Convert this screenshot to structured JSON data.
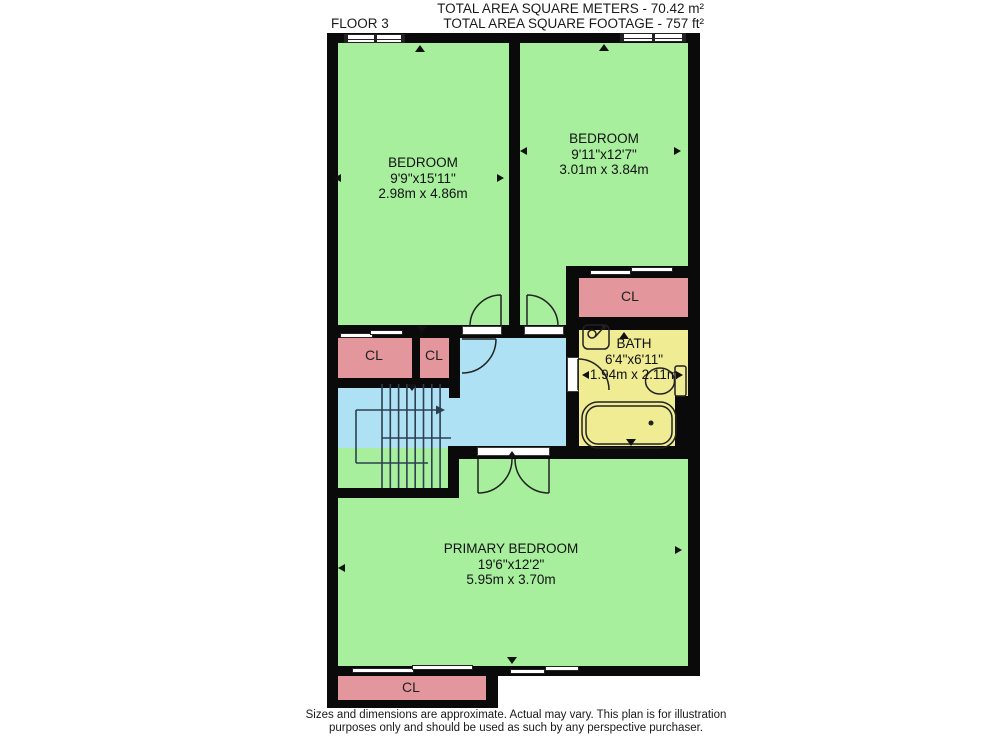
{
  "header": {
    "floor_label": "FLOOR 3",
    "total_area_metric": "TOTAL AREA SQUARE METERS - 70.42 m²",
    "total_area_imperial": "TOTAL AREA SQUARE FOOTAGE - 757 ft²"
  },
  "rooms": {
    "bedroom_left": {
      "name": "BEDROOM",
      "imperial": "9'9\"x15'11\"",
      "metric": "2.98m x 4.86m"
    },
    "bedroom_right": {
      "name": "BEDROOM",
      "imperial": "9'11\"x12'7\"",
      "metric": "3.01m x 3.84m"
    },
    "bath": {
      "name": "BATH",
      "imperial": "6'4\"x6'11\"",
      "metric": "1.94m x 2.11m"
    },
    "primary_bedroom": {
      "name": "PRIMARY BEDROOM",
      "imperial": "19'6\"x12'2\"",
      "metric": "5.95m x 3.70m"
    },
    "closet_label": "CL"
  },
  "footer": {
    "disclaimer_line1": "Sizes and dimensions are approximate. Actual may vary. This plan is for illustration",
    "disclaimer_line2": "purposes only and should be used as such by any perspective purchaser."
  },
  "colors": {
    "room_green": "#a7ef9d",
    "hall_blue": "#aee1f4",
    "closet_pink": "#e3969b",
    "bath_yellow": "#f0ec93",
    "wall_black": "#0a0a0a"
  },
  "icons": {
    "window": "double-pane-bar",
    "sliding_door": "offset-double-bar",
    "door_swing": "quarter-arc",
    "stairs": "tread-lines-with-walk-arrow",
    "bathtub": "rounded-rect-with-drain",
    "toilet": "bowl-and-tank",
    "sink": "basin-with-faucet",
    "dimension_arrow": "small-triangle"
  }
}
